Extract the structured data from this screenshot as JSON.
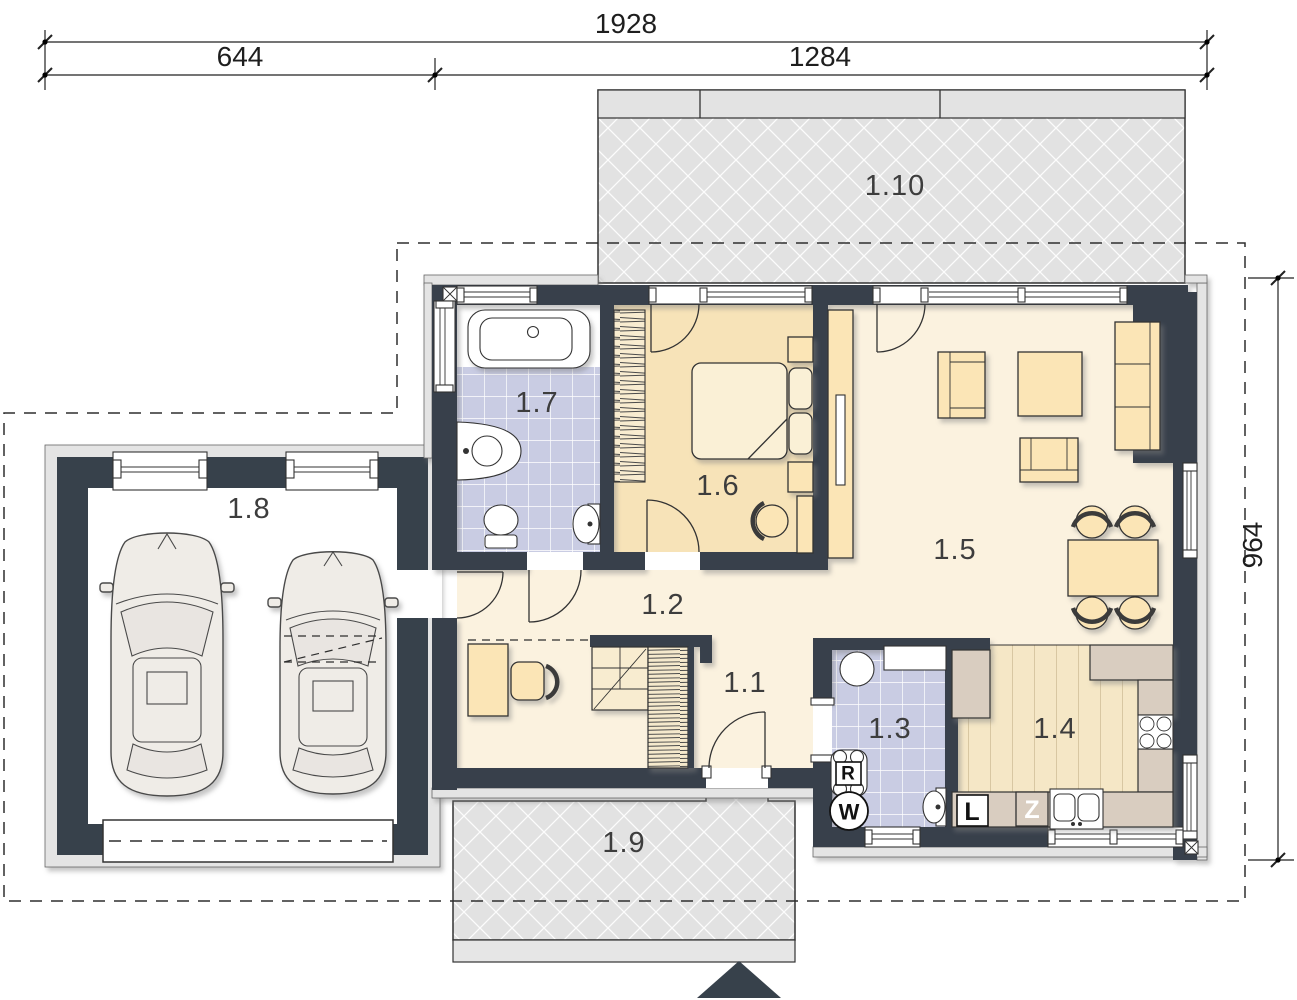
{
  "plan": {
    "dimensions": {
      "total_width": "1928",
      "left_width": "644",
      "right_width": "1284",
      "right_height": "964"
    },
    "rooms": {
      "hall_entry": "1.1",
      "corridor": "1.2",
      "utility_bath": "1.3",
      "kitchen": "1.4",
      "living_room": "1.5",
      "bedroom": "1.6",
      "bathroom": "1.7",
      "garage": "1.8",
      "porch": "1.9",
      "terrace": "1.10"
    },
    "appliance_labels": {
      "r_unit": "R",
      "w_unit": "W",
      "l_unit": "L",
      "z_unit": "Z"
    },
    "colors": {
      "wall": "#37414B",
      "floor_cream": "#FBF2DF",
      "floor_bedroom": "#F7E3B8",
      "furniture": "#FBE5B6",
      "tile": "#C9CCE3",
      "terrace_gray": "#E2E2E2",
      "counter": "#D9CDC0",
      "wood_floor": "#F5E7C6"
    }
  }
}
